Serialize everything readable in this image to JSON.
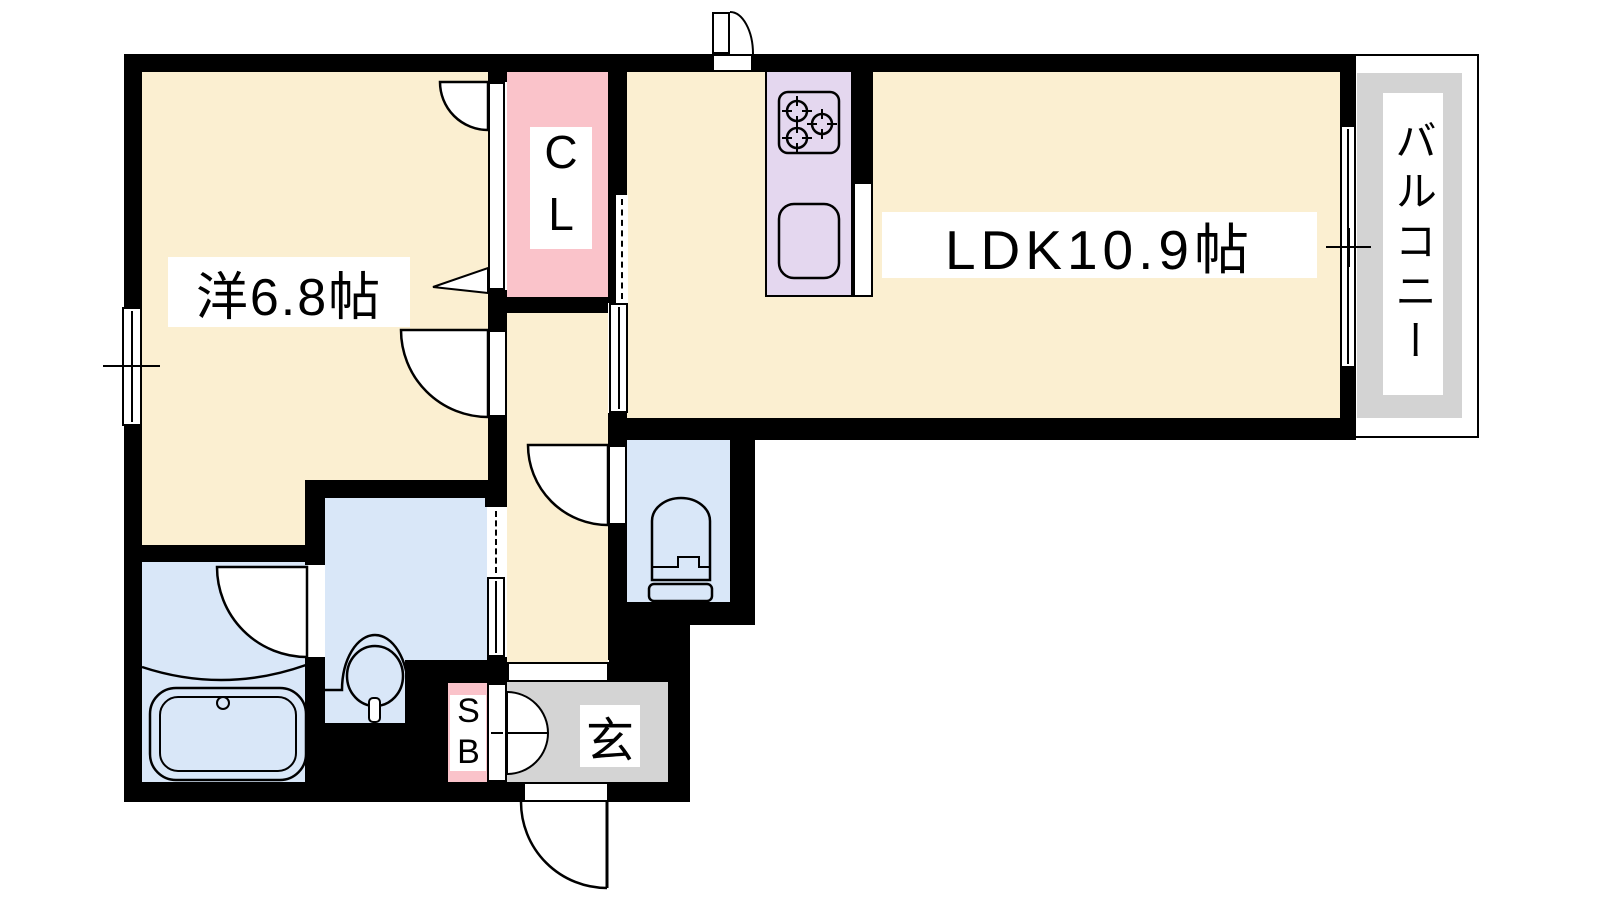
{
  "floorplan": {
    "title": "1LDK apartment floor plan",
    "rooms": {
      "bedroom": {
        "label": "洋6.8帖",
        "color": "#FBEFD1"
      },
      "ldk": {
        "label": "LDK10.9帖",
        "color": "#FBEFD1"
      },
      "closet": {
        "label": "CL",
        "color": "#FAC3CA"
      },
      "balcony": {
        "label": "バルコニー",
        "color": "#D3D3D3"
      },
      "entrance": {
        "label": "玄",
        "color": "#D4D4D4"
      },
      "shoe_box": {
        "label": "SB",
        "color": "#FAC3CA"
      },
      "hallway": {
        "color": "#FBEFD1"
      },
      "toilet": {
        "color": "#D9E7F8"
      },
      "washroom": {
        "color": "#D9E7F8"
      },
      "bathroom": {
        "color": "#D9E7F8"
      },
      "kitchen_counter": {
        "color": "#E4D7EF"
      }
    },
    "wall_color": "#000000",
    "fixtures": [
      "gas-stove",
      "kitchen-sink",
      "toilet-bowl",
      "washbasin",
      "bathtub"
    ]
  }
}
